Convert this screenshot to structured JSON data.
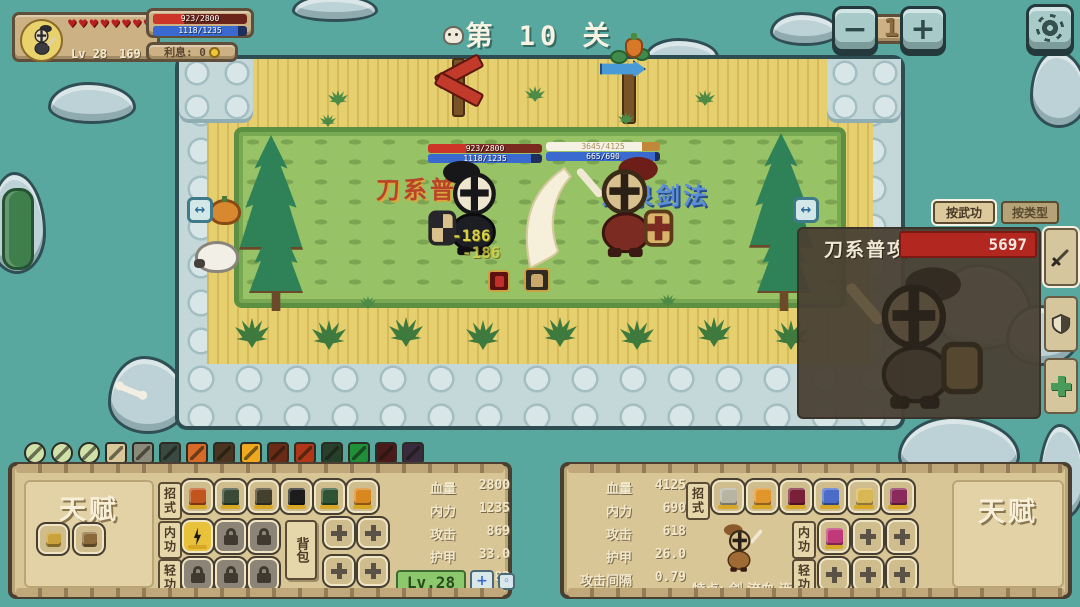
{
  "hud": {
    "hearts_count": 12,
    "level": "Lv 28",
    "gold": "169",
    "hp": "923/2800",
    "mp": "1118/1235",
    "interest": "利息: 0"
  },
  "header": {
    "stage_title": "第 10 关",
    "speed_value": "1",
    "minus": "−",
    "plus": "+"
  },
  "battle": {
    "left_skill_name": "刀系普攻",
    "right_skill_name": "血泉剑法",
    "left_hp": "923/2800",
    "left_mp": "1118/1235",
    "right_hp": "3645/4125",
    "right_mp": "665/690",
    "damage_popups": [
      "-186",
      "-186"
    ],
    "portal_glyph": "↔"
  },
  "damage_panel": {
    "tab_by_skill": "按武功",
    "tab_by_type": "按类型",
    "row_skill": "刀系普攻",
    "row_value": "5697"
  },
  "left_panel": {
    "talent_title": "天赋",
    "moves_label": "招式",
    "inner_label": "内功",
    "light_label": "轻功",
    "bag_label": "背包",
    "level_badge": "Lv.28",
    "stats": [
      {
        "label": "血量",
        "value": "2800"
      },
      {
        "label": "内力",
        "value": "1235"
      },
      {
        "label": "攻击",
        "value": "869"
      },
      {
        "label": "护甲",
        "value": "33.0"
      },
      {
        "label": "攻击间隔",
        "value": "0.83"
      }
    ]
  },
  "right_panel": {
    "talent_title": "天赋",
    "moves_label": "招式",
    "inner_label": "内功",
    "light_label": "轻功",
    "traits": "特点: 剑 流血 连击",
    "stats": [
      {
        "label": "血量",
        "value": "4125"
      },
      {
        "label": "内力",
        "value": "690"
      },
      {
        "label": "攻击",
        "value": "618"
      },
      {
        "label": "护甲",
        "value": "26.0"
      },
      {
        "label": "攻击间隔",
        "value": "0.79"
      }
    ]
  },
  "toolbar": {
    "icons": [
      {
        "name": "bolt-orb",
        "shape": "circle",
        "color": "#cfe0a8"
      },
      {
        "name": "pot-orb",
        "shape": "circle",
        "color": "#cfe0a8"
      },
      {
        "name": "swirl-orb",
        "shape": "circle",
        "color": "#cfe0a8"
      },
      {
        "name": "bolt-card",
        "shape": "square",
        "color": "#d8c89a"
      },
      {
        "name": "pot-card",
        "shape": "square",
        "color": "#8a8a7a"
      },
      {
        "name": "swirl-card",
        "shape": "square",
        "color": "#3a4a42"
      },
      {
        "name": "explosion-card",
        "shape": "square",
        "color": "#d86a28"
      },
      {
        "name": "cross-swords-card",
        "shape": "square",
        "color": "#4a3420"
      },
      {
        "name": "sun-burst-card",
        "shape": "square",
        "color": "#f0a81f"
      },
      {
        "name": "fire-burst-card",
        "shape": "square",
        "color": "#6a2a16"
      },
      {
        "name": "slash-card",
        "shape": "square",
        "color": "#b03618"
      },
      {
        "name": "poison-pot-card",
        "shape": "square",
        "color": "#26402c"
      },
      {
        "name": "green-ring-card",
        "shape": "square",
        "color": "#1f8f3a"
      },
      {
        "name": "dark-red-card",
        "shape": "square",
        "color": "#4a1a1a"
      },
      {
        "name": "purple-card",
        "shape": "square",
        "color": "#3a2a3e"
      }
    ]
  },
  "colors": {
    "background_teal": "#58a89f",
    "hp_red": "#cc3528",
    "mp_blue": "#3a6ad0",
    "enemy_hp_white": "#f5f1e4",
    "enemy_hp_track": "#c2883a",
    "panel_dark": "#4a4034",
    "damage_bar_red": "#b2271f",
    "parchment": "#cbb184",
    "board_tan": "#d9c697",
    "level_green": "#8cc96c",
    "skill_left_text": "#b8442a",
    "skill_right_text": "#5a8fd8",
    "damage_popup_yellow": "#d8d049"
  }
}
